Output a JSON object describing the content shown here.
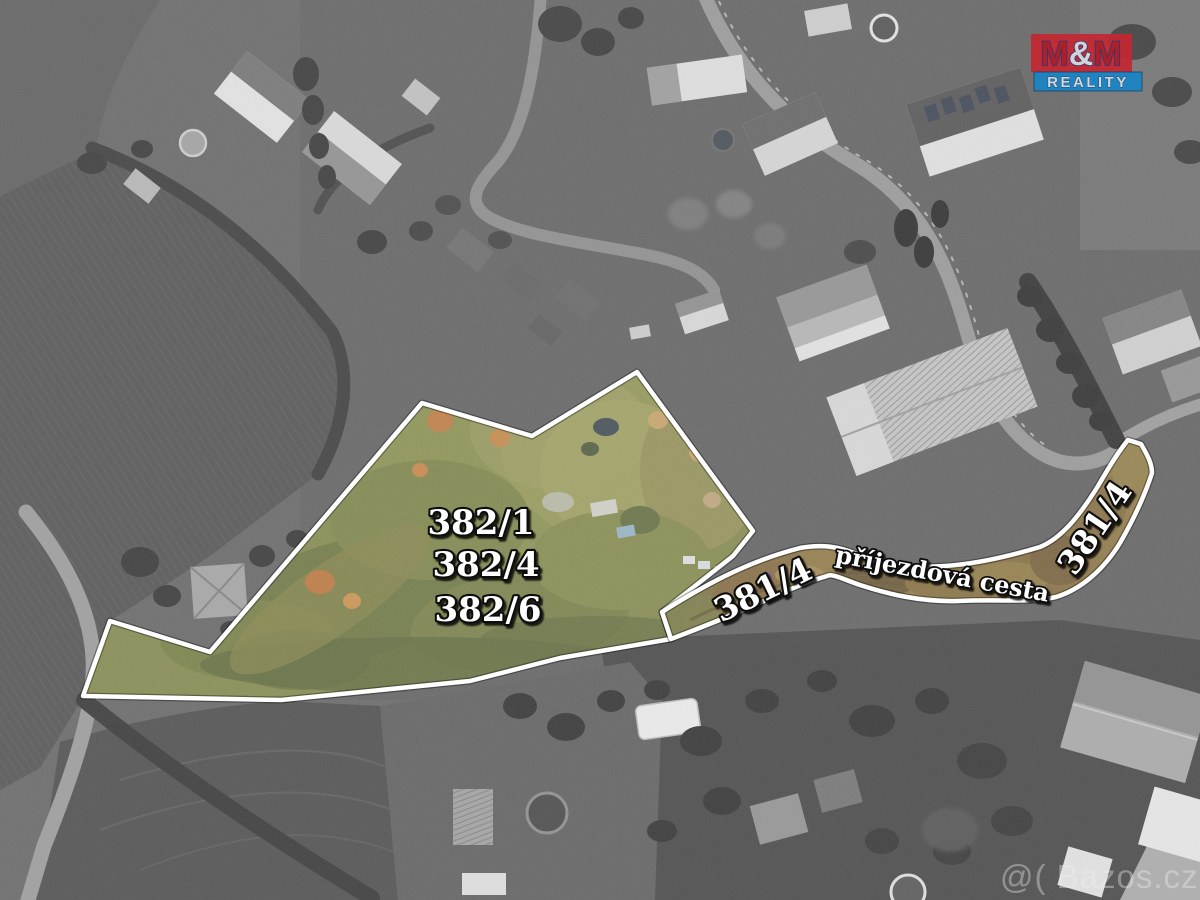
{
  "labels": {
    "l382_1": "382/1",
    "l382_4": "382/4",
    "l382_6": "382/6",
    "road_left": "381/4",
    "road_right": "381/4",
    "access_road": "příjezdová cesta"
  },
  "logo": {
    "m1": "M",
    "amp": "&",
    "m2": "M",
    "reality": "REALITY"
  },
  "watermark": {
    "text": "@( Bazos.cz"
  },
  "colors": {
    "highlight_outline": "#ffffff",
    "parcel_tint": "#7a8038",
    "access_road_tint": "#7a5c2a",
    "logo_red": "#c42832",
    "logo_blue": "#1b84c4"
  }
}
